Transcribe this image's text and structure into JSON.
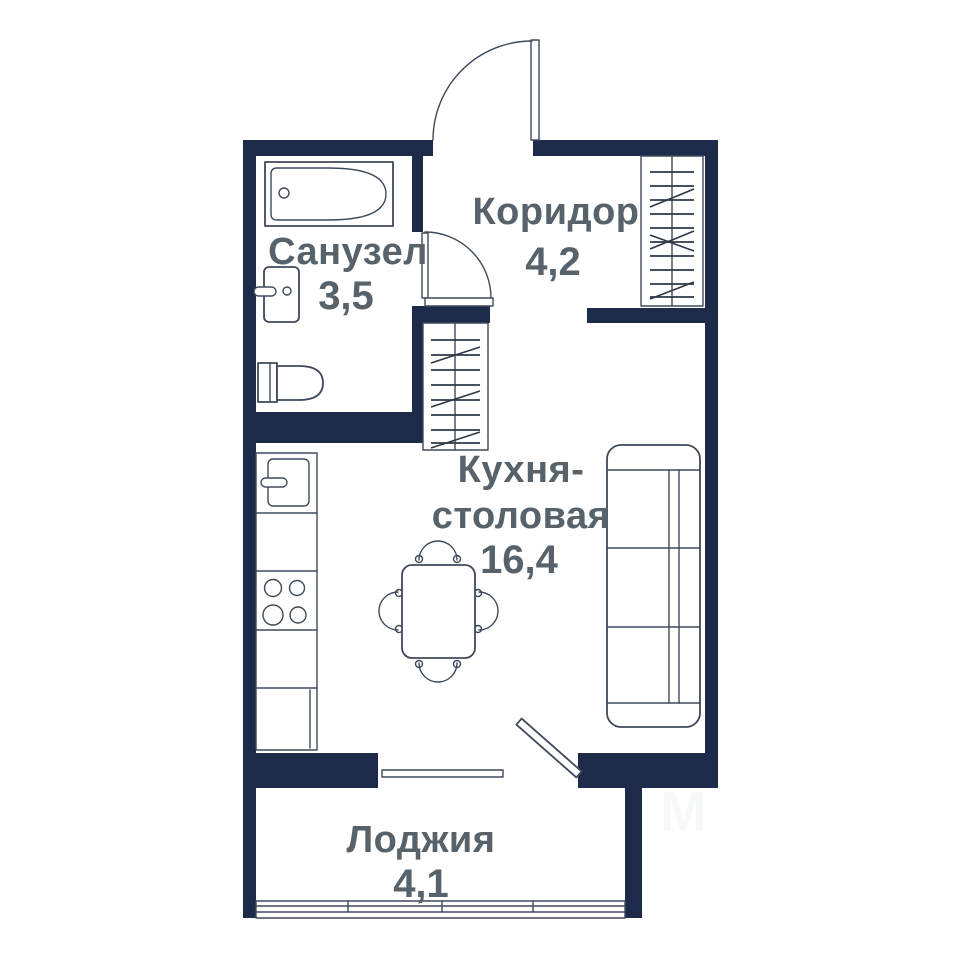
{
  "colors": {
    "wall": "#1d2a4a",
    "line": "#3e4a5a",
    "hatch": "#2e3947",
    "text": "#57626b",
    "bg": "#ffffff"
  },
  "plan": {
    "type": "apartment-floor-plan",
    "rooms": [
      {
        "id": "bathroom",
        "name": "Санузел",
        "area": "3,5"
      },
      {
        "id": "corridor",
        "name": "Коридор",
        "area": "4,2"
      },
      {
        "id": "kitchen-dining",
        "name_line1": "Кухня-",
        "name_line2": "столовая",
        "area": "16,4"
      },
      {
        "id": "loggia",
        "name": "Лоджия",
        "area": "4,1"
      }
    ],
    "fixtures": [
      "entrance-door",
      "bathroom-door",
      "balcony-door",
      "bathtub",
      "sink",
      "toilet",
      "wardrobe-corridor",
      "wardrobe-hall",
      "fridge",
      "stove",
      "kitchen-counter",
      "dining-table",
      "chairs",
      "sofa",
      "kitchen-window",
      "loggia-glazing"
    ],
    "watermark": "M"
  }
}
